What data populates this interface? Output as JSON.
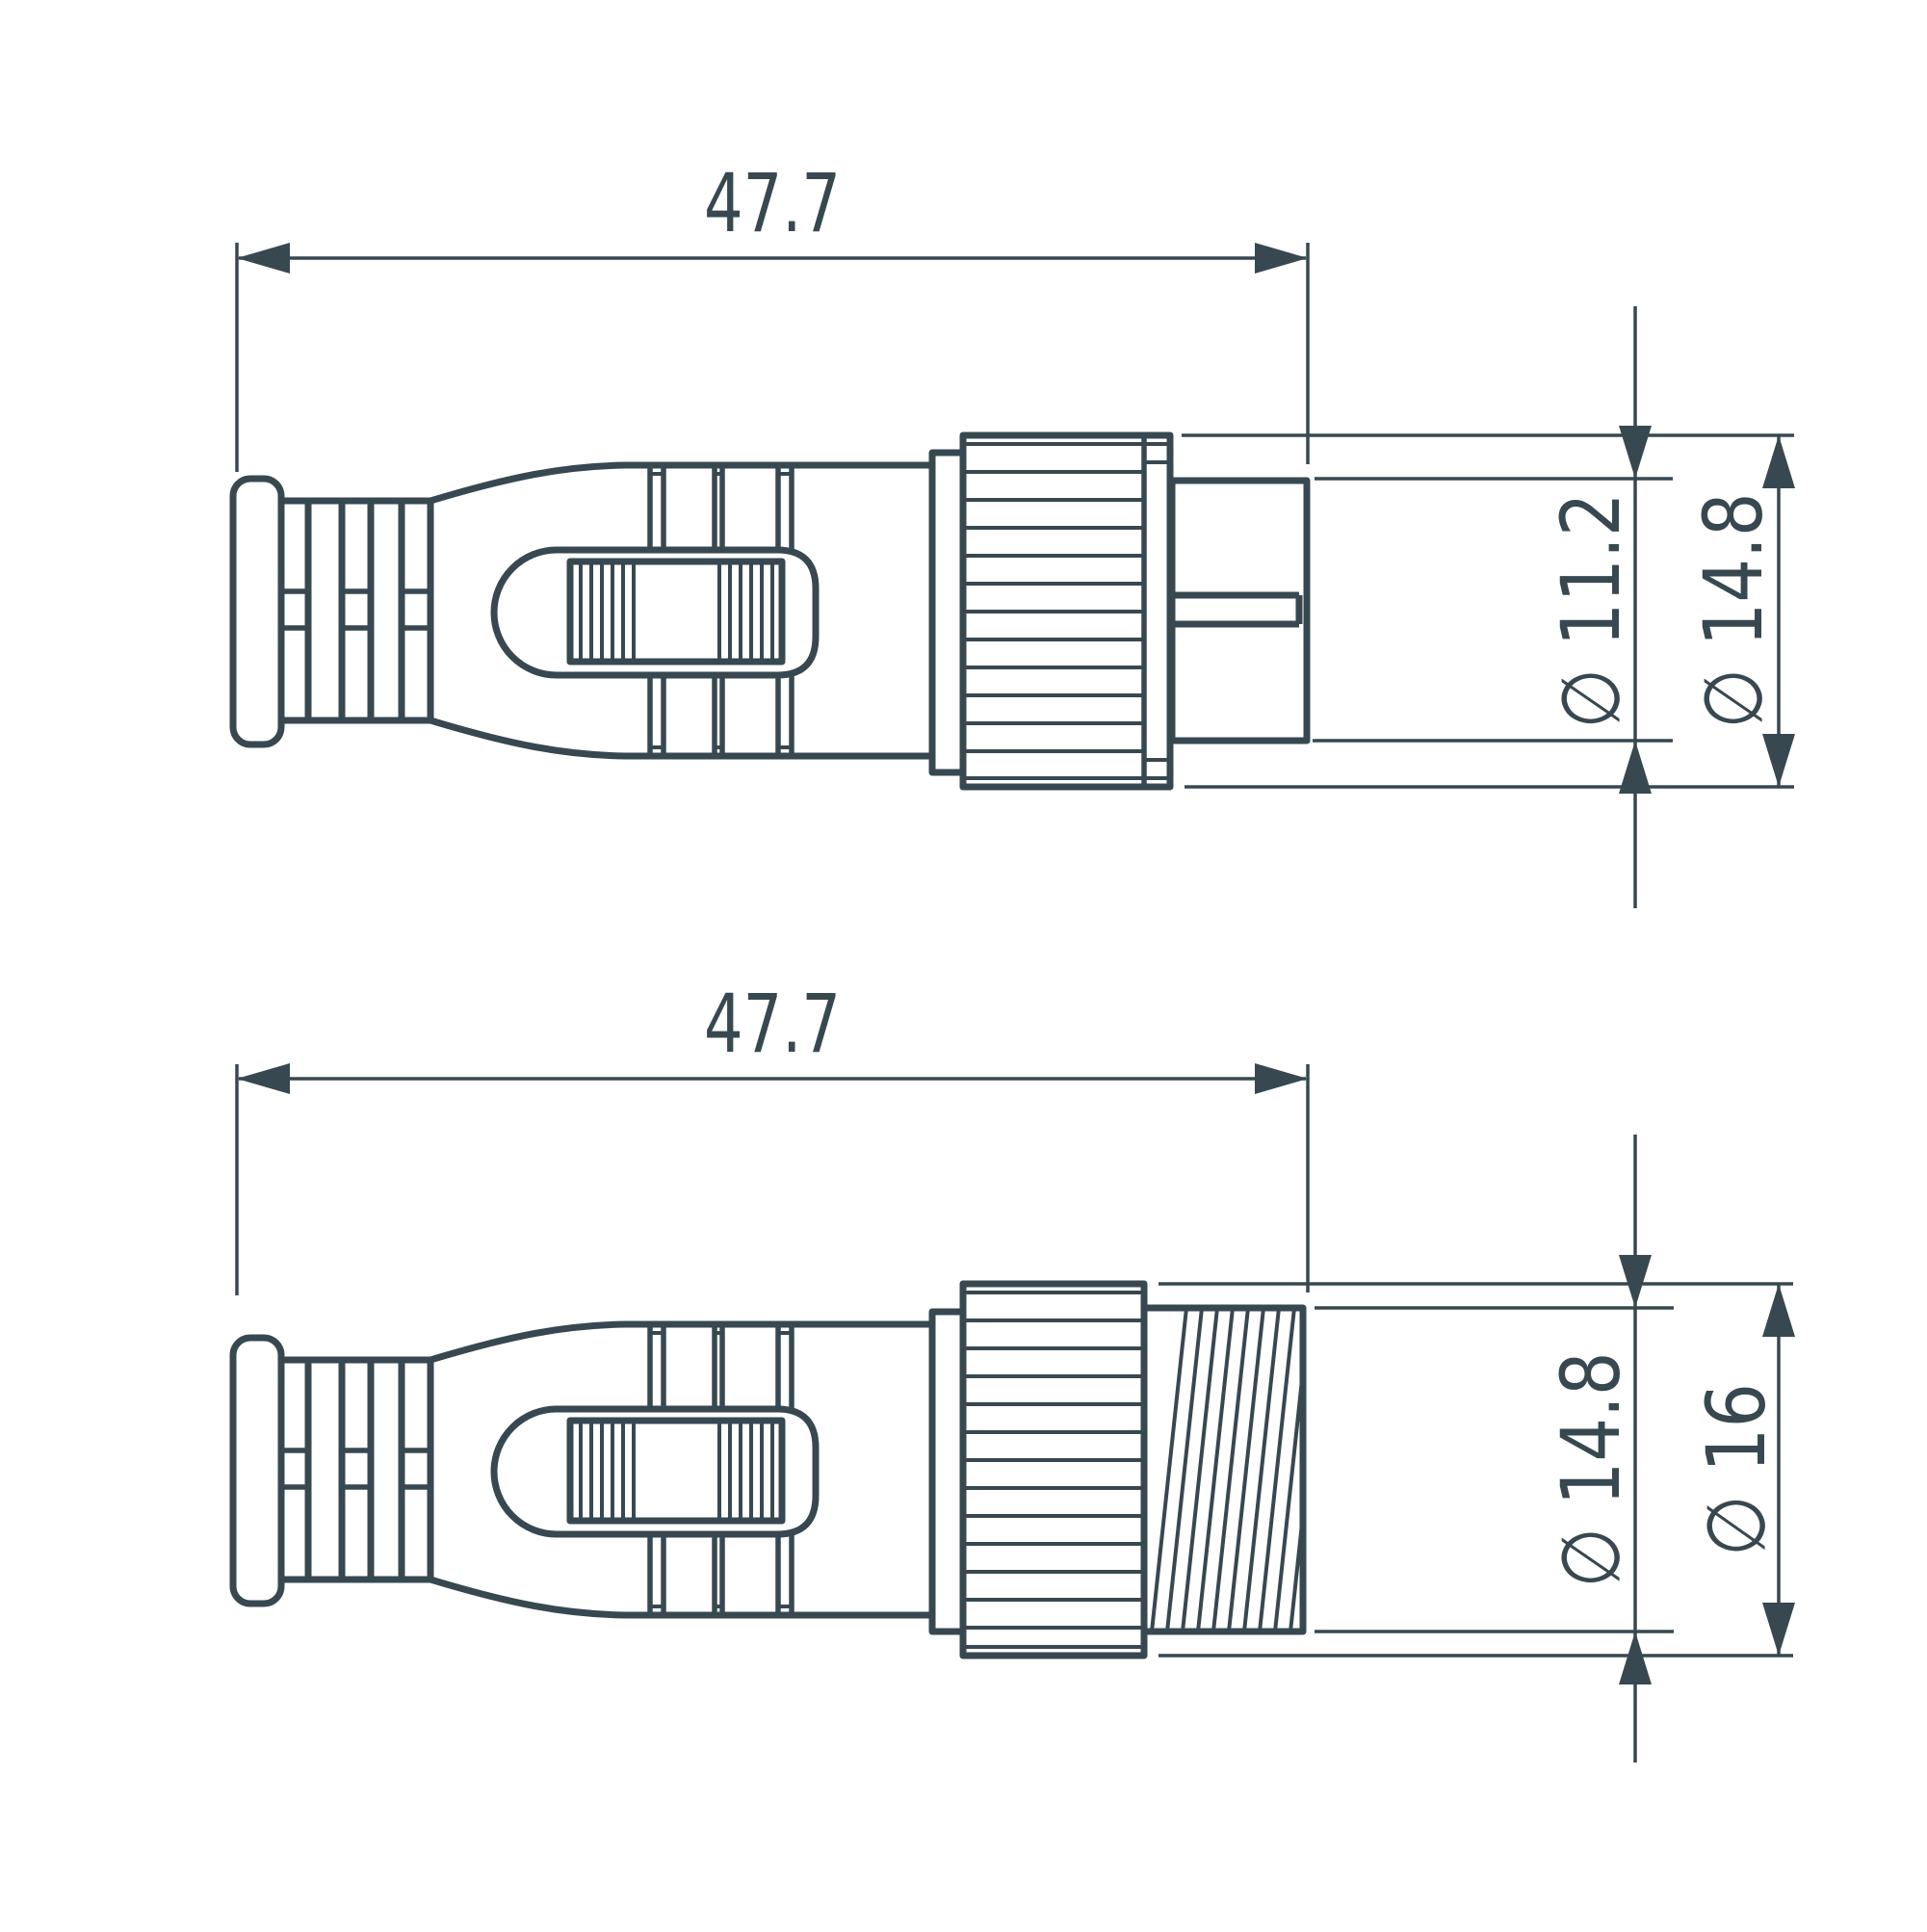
{
  "colors": {
    "ink": "#374850",
    "background": "#ffffff"
  },
  "views": {
    "top": {
      "dims": {
        "length": {
          "label": "47.7",
          "value_mm": 47.7
        },
        "pin_diameter": {
          "label": "∅ 11.2",
          "value_mm": 11.2
        },
        "nut_diameter": {
          "label": "∅ 14.8",
          "value_mm": 14.8
        }
      }
    },
    "bottom": {
      "dims": {
        "length": {
          "label": "47.7",
          "value_mm": 47.7
        },
        "thread_diameter": {
          "label": "∅ 14.8",
          "value_mm": 14.8
        },
        "nut_diameter": {
          "label": "∅ 16",
          "value_mm": 16
        }
      }
    }
  }
}
